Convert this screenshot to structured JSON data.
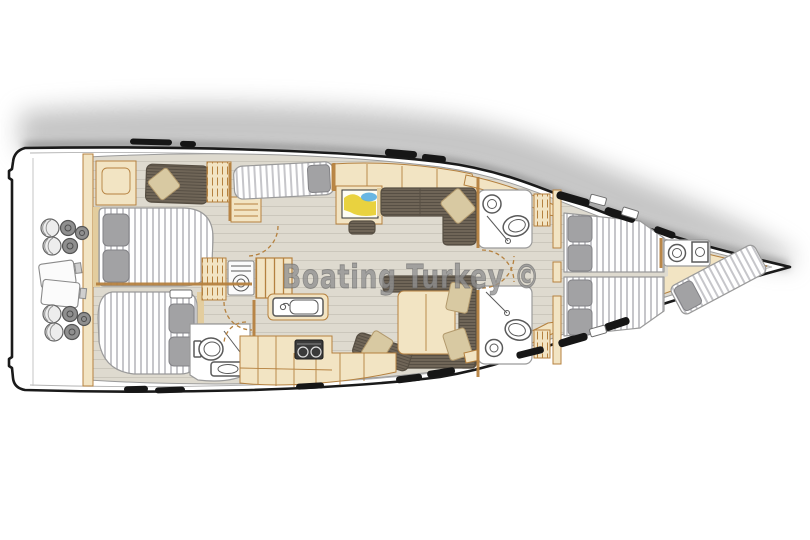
{
  "diagram": {
    "watermark": "Boating Turkey ©"
  },
  "palette": {
    "page-bg": "#ffffff",
    "hull-fill": "#ffffff",
    "hull-stroke": "#1a1a1a",
    "shadow": "#8a8a8a",
    "floor": "#dedacf",
    "plank": "#cbc7bc",
    "wood": "#f2e4c3",
    "wood-dark": "#e3cd9e",
    "wood-stroke": "#b5813f",
    "settee": "#6f6557",
    "settee-line": "#574f43",
    "cushion": "#d8c9a2",
    "mattress": "#ffffff",
    "mattress-stripe": "#c6c6ca",
    "mattress-stroke": "#9a9a9a",
    "pillow": "#a2a2a4",
    "fixture-stroke": "#5a5a5a",
    "window": "#161616",
    "stove": "#3a3a3a",
    "watermark": "#909090",
    "map-yellow": "#e9d23f",
    "map-blue": "#58aee0"
  }
}
